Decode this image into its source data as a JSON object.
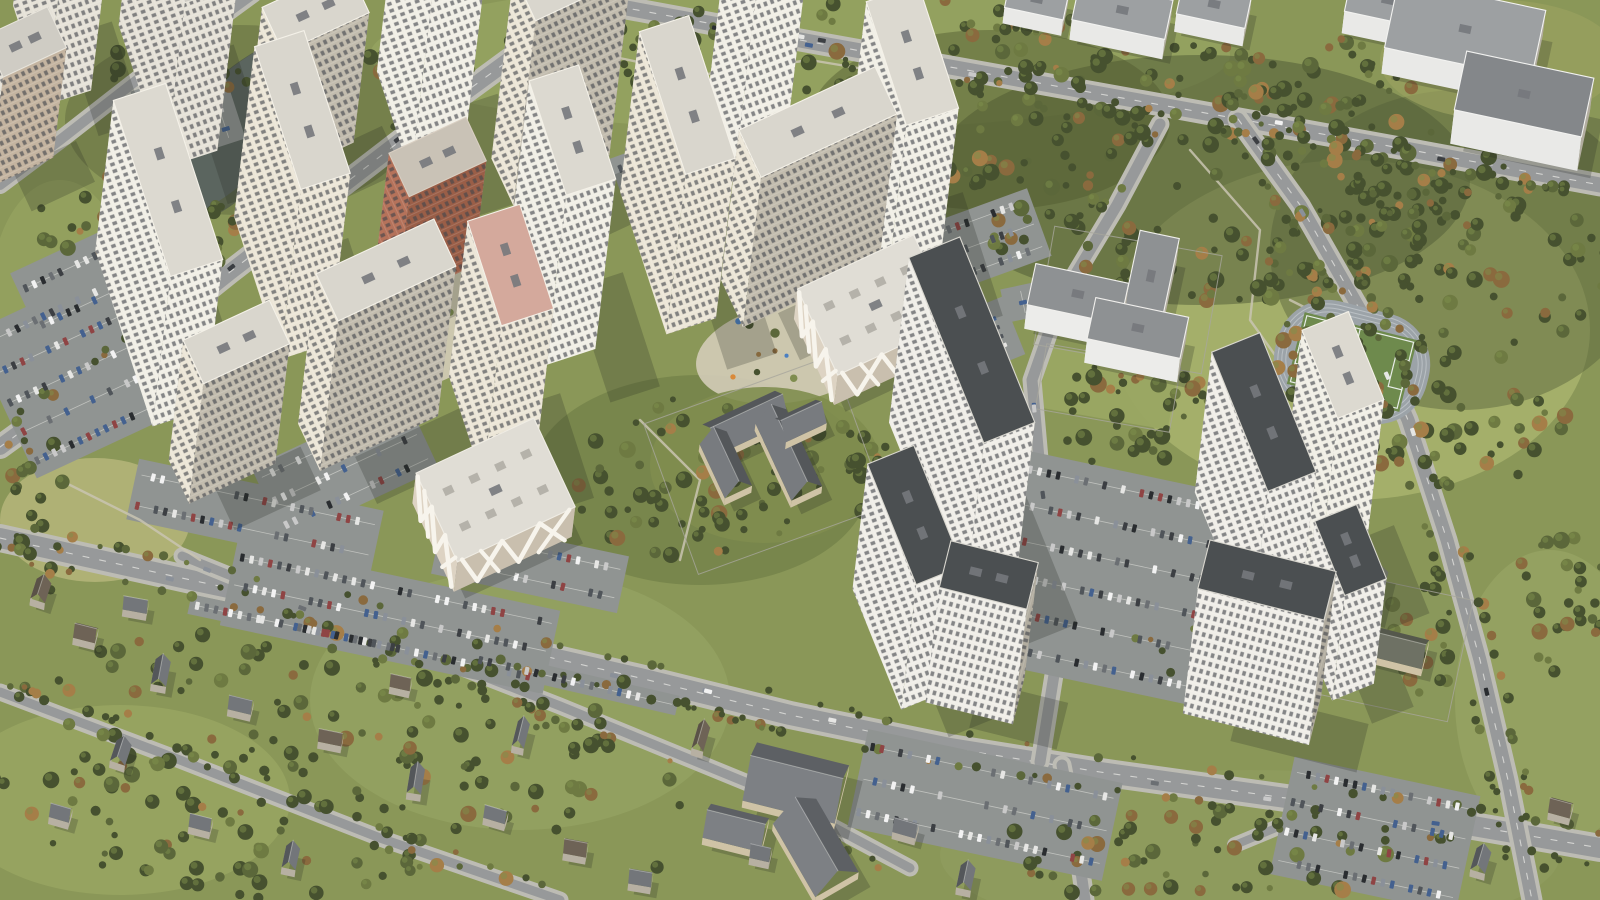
{
  "scene": {
    "description": "High-angle oblique aerial 3D render of a large new residential complex: clusters of white and cream high-rise apartment towers around landscaped courtyards, two parking garages with white organic facade patterns, a school and kindergartens, full surface parking lots, a pond, a football field with running track, dense autumn forest, a low-rise suburb and arterial roads with traffic.",
    "view": "aerial-oblique",
    "time_of_day": "day",
    "visible_text": [],
    "elements": [
      "pond",
      "main-residential-complex",
      "serpentine-residential-block",
      "old-neighborhood-towers",
      "parking-garage-1",
      "parking-garage-2",
      "school-building",
      "kindergarten-building",
      "football-field",
      "running-track",
      "forest",
      "suburb-houses",
      "industrial-buildings",
      "surface-parking-lots",
      "arterial-road",
      "street-trees",
      "courtyard-playgrounds"
    ]
  },
  "palette": {
    "grassBase": "#8a9758",
    "grassLight": "#a5b06c",
    "grassPale": "#b2b479",
    "meadow": "#9aa763",
    "parkBand": "#94a260",
    "forestDark": "#46512f",
    "forestMid": "#5b673a",
    "forestOlive": "#6e7a42",
    "rust": "#8a6a3e",
    "rustLight": "#a57e48",
    "treeLight": "#7d8f4c",
    "water": "#5b655f",
    "waterRim": "#4a5348",
    "roadAsphalt": "#97999a",
    "roadCasing": "#bdbcb4",
    "laneWhite": "#f2f2ee",
    "lotAsphalt": "#909492",
    "lotLine": "#e8e8e2",
    "towerLit": "#ece6d7",
    "towerWhite": "#f1efe6",
    "towerShade": "#c2bcae",
    "towerShade2": "#b2ada0",
    "roofLight": "#d9d6cd",
    "parapet": "#f4f1e8",
    "darkRoof": "#4b4f51",
    "darkRoofTrim": "#d9d7cf",
    "brickLit": "#b5725a",
    "brickShade": "#9a5e47",
    "pinkRoof": "#d4a99c",
    "oldLit": "#e6e2d8",
    "oldShade": "#c4b4a0",
    "oldRoof": "#cfccc4",
    "windowDark": "rgba(66,69,76,0.78)",
    "garageWall": "#ddd3c3",
    "garageShade": "#c9bfae",
    "garageRoof": "#e0ddd5",
    "garagePattern": "#f7f4ec",
    "skylight": "#b5b2aa",
    "schoolWall": "#cfc3a6",
    "roofDarkSide": "#54575a",
    "roofLightSide": "#787b7f",
    "houseWall": "#b7b0a2",
    "houseRoofBrown": "#6e6356",
    "indWall": "#e9e9e7",
    "indRoof": "#9da0a2",
    "indRoofDark": "#84878a",
    "trackGray": "#9ca3a8",
    "trackLane": "#c2c7ca",
    "pitchGreen": "#6e8a4d",
    "fieldLine": "#e8ede8",
    "yardTan": "#d3ccb8",
    "pathLight": "#c9c4b2",
    "fence": "#a8a69c",
    "shadow": "rgba(38,42,34,0.24)",
    "carColors": [
      "#f2f2f2",
      "#e6e6e4",
      "#2a2d30",
      "#50555a",
      "#8a9099",
      "#44618f",
      "#8f4444",
      "#c9c9c9",
      "#6b6f73",
      "#3c3f43"
    ]
  }
}
